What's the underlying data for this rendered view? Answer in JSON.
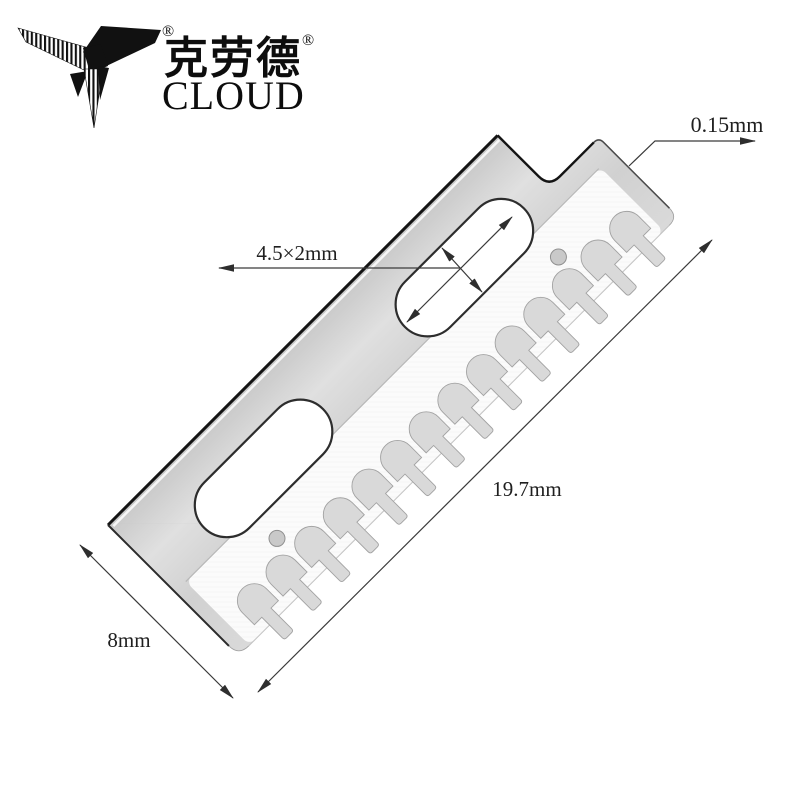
{
  "logo": {
    "mark": "bird-logo",
    "registered_mark": "®",
    "brand_cjk": "克劳德",
    "brand_cjk_registered": "®",
    "brand_latin": "CLOUD"
  },
  "annotations": {
    "thickness": "0.15mm",
    "slot_size": "4.5×2mm",
    "blade_length": "19.7mm",
    "blade_width": "8mm"
  },
  "blade": {
    "teeth_count": 14,
    "slot_hole_count": 2,
    "pin_hole_count": 2
  },
  "colors": {
    "background": "#ffffff",
    "metal_body": "#d7d7d7",
    "metal_facet": "#fafafa",
    "teeth": "#d9d9d9",
    "edge_dark": "#141414",
    "dimension_lines": "#3a3a3a",
    "text": "#1f1f1f",
    "logo": "#111111"
  }
}
